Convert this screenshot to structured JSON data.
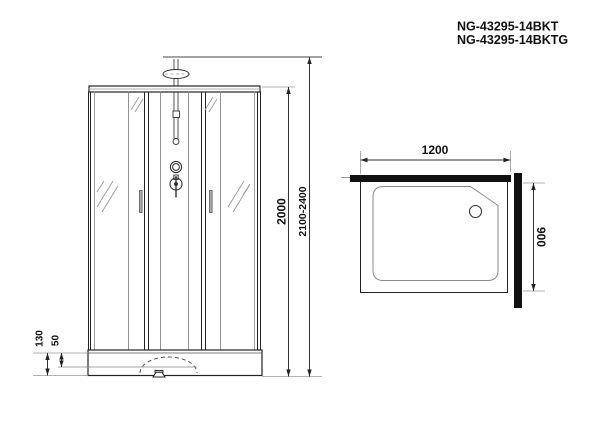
{
  "product_codes": {
    "line1": "NG-43295-14BKT",
    "line2": "NG-43295-14BKTG"
  },
  "front_view": {
    "dim_cabin_height": "2000",
    "dim_total_height": "2100-2400",
    "dim_tray_height": "130",
    "dim_tray_inner_depth": "50"
  },
  "top_view": {
    "dim_width": "1200",
    "dim_depth": "900"
  },
  "colors": {
    "line_dark": "#1a1a1a",
    "line_mid": "#555555",
    "line_light": "#999999",
    "wall_fill": "#111111",
    "background": "#ffffff"
  }
}
